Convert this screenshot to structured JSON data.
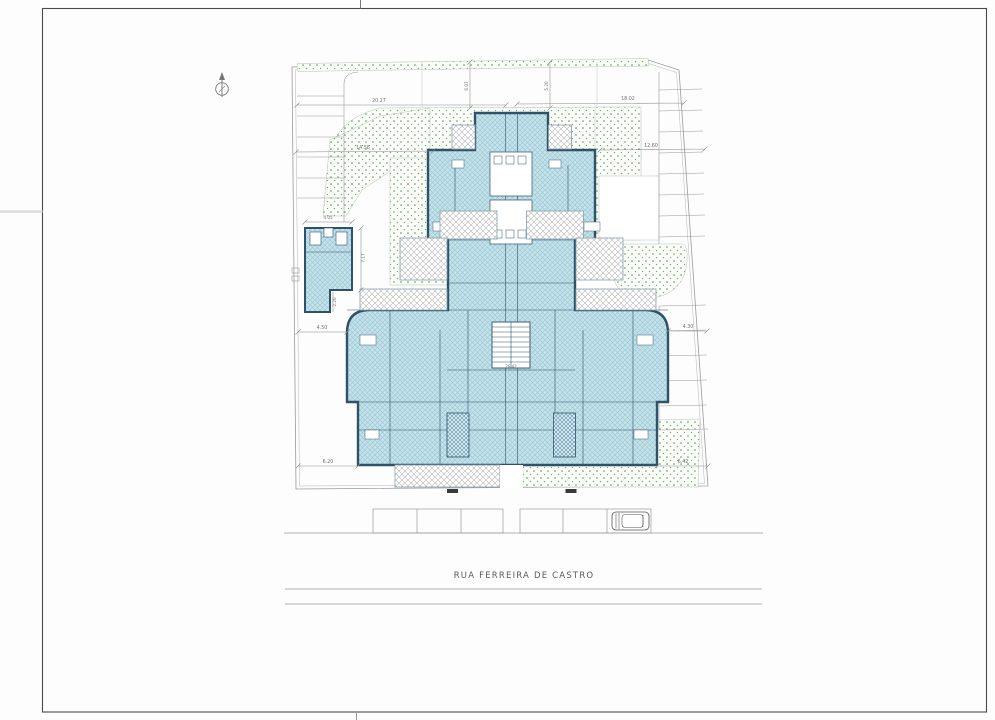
{
  "drawing": {
    "street_label": "RUA FERREIRA DE CASTRO",
    "dimensions": {
      "top_left": "20.27",
      "top_right": "18.02",
      "upper_left": "14.56",
      "upper_right": "12.60",
      "cap_left": "6.07",
      "cap_right": "5.20",
      "annex_width": "4.05",
      "annex_depth": "7.17",
      "annex_step": "2.20",
      "side_left": "4.50",
      "side_right": "4.30",
      "bottom_left": "6.20",
      "bottom_right": "6.42",
      "corridor_length": "26.42"
    },
    "colors": {
      "building_fill": "#C3E3EB",
      "building_wall": "#2F5269",
      "landscape_dot": "#4E9A4E",
      "terrace_hatch": "#B5B5B5",
      "line_gray": "#8A8A8A"
    }
  }
}
